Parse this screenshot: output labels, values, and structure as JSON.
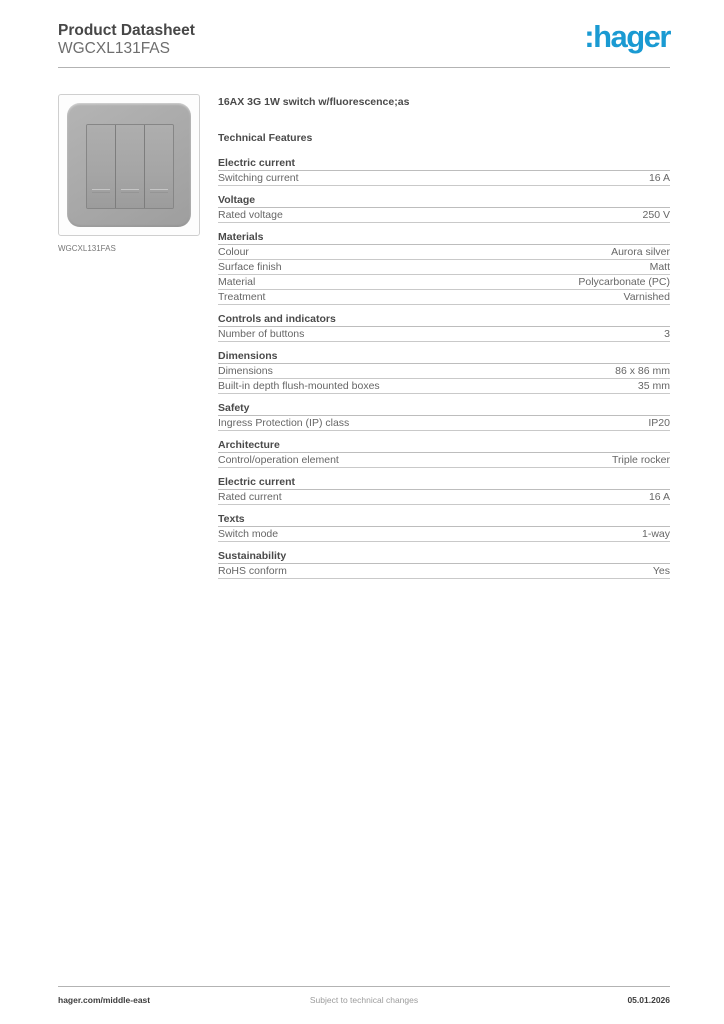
{
  "header": {
    "title": "Product Datasheet",
    "subtitle": "WGCXL131FAS",
    "logo_text": ":hager",
    "brand_color": "#1a9ad2"
  },
  "product": {
    "image_caption": "WGCXL131FAS",
    "title": "16AX 3G 1W switch w/fluorescence;as",
    "features_heading": "Technical Features"
  },
  "sections": [
    {
      "heading": "Electric current",
      "rows": [
        {
          "label": "Switching current",
          "value": "16 A"
        }
      ]
    },
    {
      "heading": "Voltage",
      "rows": [
        {
          "label": "Rated voltage",
          "value": "250 V"
        }
      ]
    },
    {
      "heading": "Materials",
      "rows": [
        {
          "label": "Colour",
          "value": "Aurora silver"
        },
        {
          "label": "Surface finish",
          "value": "Matt"
        },
        {
          "label": "Material",
          "value": "Polycarbonate (PC)"
        },
        {
          "label": "Treatment",
          "value": "Varnished"
        }
      ]
    },
    {
      "heading": "Controls and indicators",
      "rows": [
        {
          "label": "Number of buttons",
          "value": "3"
        }
      ]
    },
    {
      "heading": "Dimensions",
      "rows": [
        {
          "label": "Dimensions",
          "value": "86 x 86 mm"
        },
        {
          "label": "Built-in depth flush-mounted boxes",
          "value": "35 mm"
        }
      ]
    },
    {
      "heading": "Safety",
      "rows": [
        {
          "label": "Ingress Protection (IP) class",
          "value": "IP20"
        }
      ]
    },
    {
      "heading": "Architecture",
      "rows": [
        {
          "label": "Control/operation element",
          "value": "Triple rocker"
        }
      ]
    },
    {
      "heading": "Electric current",
      "rows": [
        {
          "label": "Rated current",
          "value": "16 A"
        }
      ]
    },
    {
      "heading": "Texts",
      "rows": [
        {
          "label": "Switch mode",
          "value": "1-way"
        }
      ]
    },
    {
      "heading": "Sustainability",
      "rows": [
        {
          "label": "RoHS conform",
          "value": "Yes"
        }
      ]
    }
  ],
  "footer": {
    "left": "hager.com/middle-east",
    "center": "Subject to technical changes",
    "right": "05.01.2026"
  }
}
